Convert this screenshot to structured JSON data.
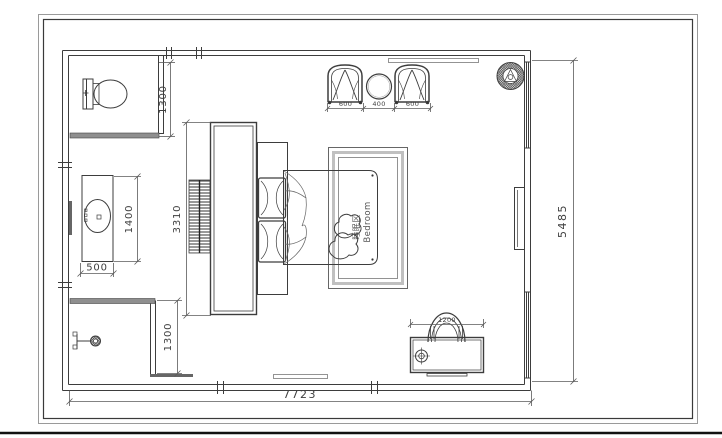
{
  "room": {
    "label_cn": "睡眠区",
    "label_en": "Bedroom"
  },
  "dims": {
    "overall_width": "7723",
    "overall_depth": "5485",
    "wc_depth": "1300",
    "vanity_length": "1400",
    "vanity_depth": "500",
    "wardrobe_length": "3310",
    "shower_depth": "1300",
    "armchair_left": "600",
    "side_table": "400",
    "armchair_right": "600",
    "desk_length": "1200"
  },
  "colors": {
    "line": "#3d3d3d",
    "frame": "#444444",
    "wet_wall": "#8f8f8f",
    "background": "#ffffff"
  }
}
